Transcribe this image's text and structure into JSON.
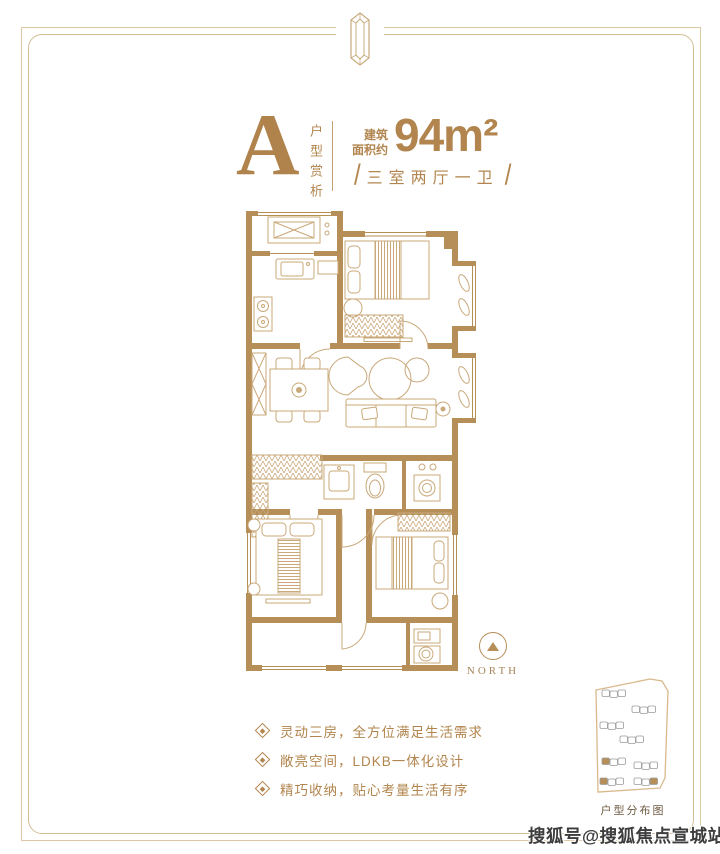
{
  "meta": {
    "accent_gold": "#b2854e",
    "wall_gold": "#b58e58",
    "furniture_line": "#c9a87a",
    "frame_line": "#d5bd96"
  },
  "header": {
    "unit_letter": "A",
    "unit_caption": "户型赏析",
    "area_label_line1": "建筑",
    "area_label_line2": "面积约",
    "area_value": "94m²",
    "slash": "/",
    "layout_spec": "三室两厅一卫"
  },
  "compass": {
    "label": "NORTH"
  },
  "features": {
    "items": [
      "灵动三房，全方位满足生活需求",
      "敞亮空间，LDKB一体化设计",
      "精巧收纳，贴心考量生活有序"
    ]
  },
  "sitemap": {
    "caption": "户型分布图"
  },
  "watermark": {
    "text": "搜狐号@搜狐焦点宣城站"
  }
}
